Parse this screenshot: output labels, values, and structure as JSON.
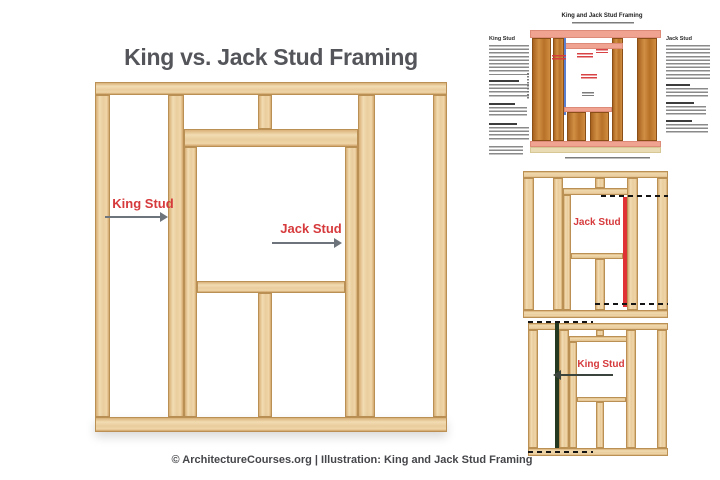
{
  "header": {
    "title": "King vs. Jack Stud Framing"
  },
  "main_diagram": {
    "king_label": "King Stud",
    "jack_label": "Jack Stud"
  },
  "infographic_thumb": {
    "title": "King and Jack Stud Framing",
    "king_heading": "King Stud",
    "jack_heading": "Jack Stud"
  },
  "jack_thumb": {
    "label": "Jack Stud"
  },
  "king_thumb": {
    "label": "King Stud"
  },
  "footer": {
    "attribution": "© ArchitectureCourses.org | Illustration: King and Jack Stud Framing"
  },
  "colors": {
    "label_red": "#d63a3c",
    "arrow_gray": "#6e747b",
    "wood_light": "#ecd0a2",
    "wood_orange": "#c17c33",
    "salmon_plate": "#efa390",
    "highlight_red": "#e03234",
    "highlight_green": "#23381e",
    "king_line_blue": "#5b7fd0",
    "title_gray": "#54555a"
  }
}
